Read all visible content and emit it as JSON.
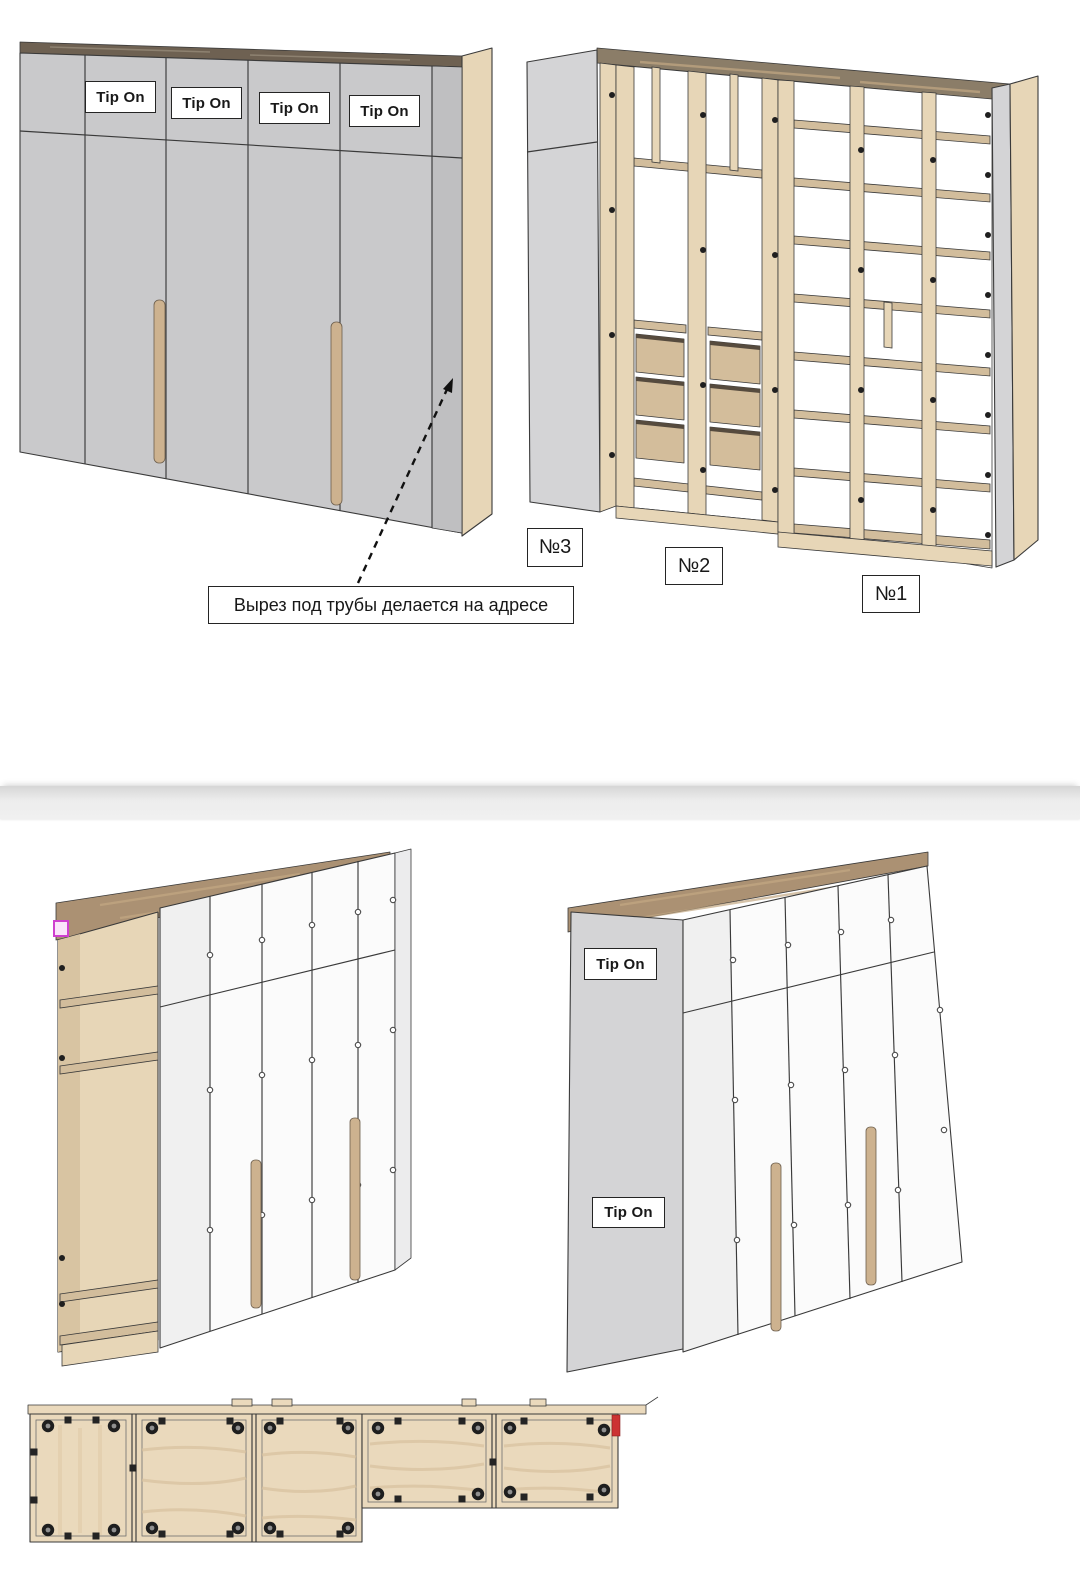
{
  "labels": {
    "tip_on_top": [
      "Tip On",
      "Tip On",
      "Tip On",
      "Tip On"
    ],
    "annotation": "Вырез под трубы делается на адресе",
    "units": [
      "№3",
      "№2",
      "№1"
    ],
    "tip_on_bottom": [
      "Tip On",
      "Tip On"
    ]
  },
  "colors": {
    "door_gray": "#c9c9cb",
    "filler_gray": "#bfbfc1",
    "side_gray": "#d4d4d6",
    "wood_light": "#e7d6b7",
    "wood_mid": "#d2bd9c",
    "wood_drawer": "#d3bd9b",
    "wood_handle": "#cdb28f",
    "wood_top_dark": "#6e6152",
    "wood_top": "#8b7d68",
    "wood_plan": "#ead9bc",
    "white_door": "#fbfbfb",
    "white_side": "#ececed",
    "outline": "#3a3a3a",
    "red_marker": "#cc3333",
    "pink_marker": "#cf3fcf",
    "divider_band": "#f0f0f0"
  }
}
